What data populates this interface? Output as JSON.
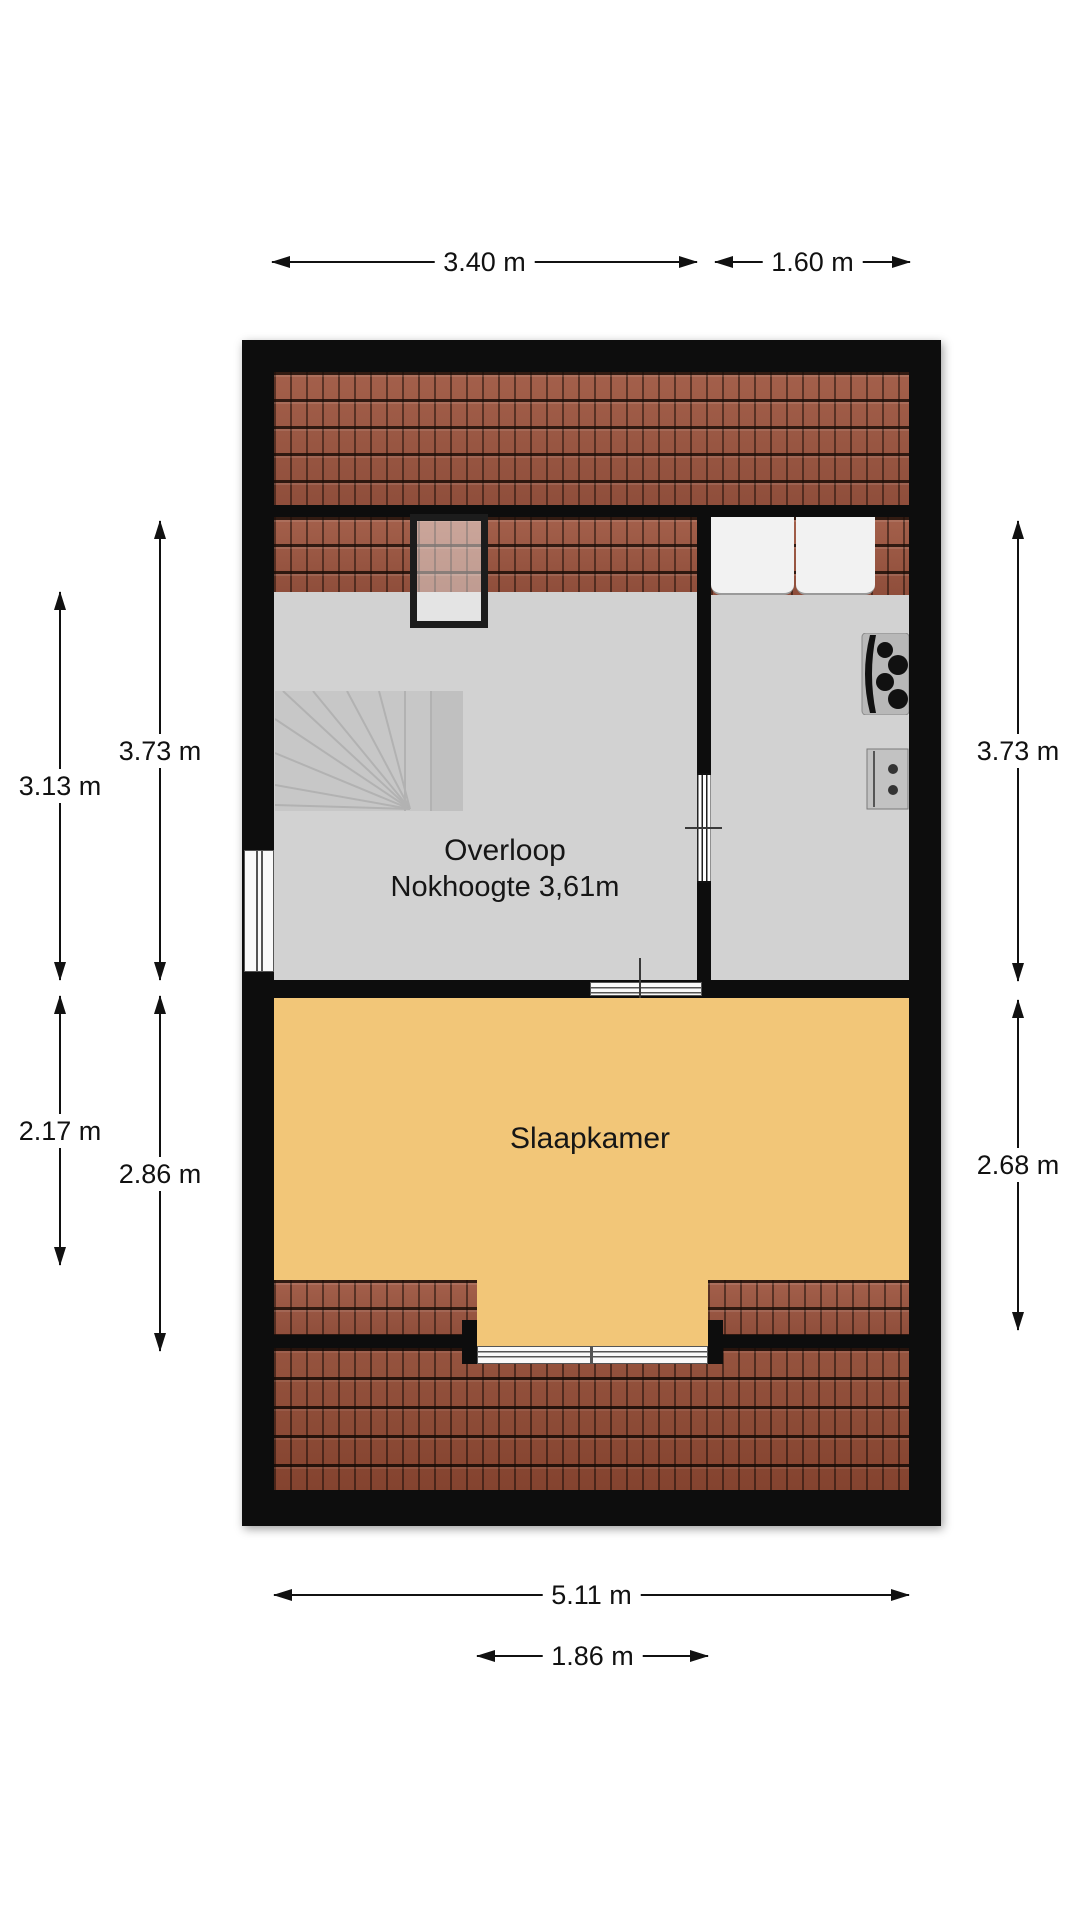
{
  "floorplan": {
    "rooms": {
      "overloop": {
        "label": "Overloop",
        "sub_label": "Nokhoogte 3,61m"
      },
      "slaapkamer": {
        "label": "Slaapkamer"
      }
    },
    "dimensions": {
      "top_left": "3.40 m",
      "top_right": "1.60 m",
      "left_outer_upper": "3.13 m",
      "left_inner_upper": "3.73 m",
      "left_outer_lower": "2.17 m",
      "left_inner_lower": "2.86 m",
      "right_upper": "3.73 m",
      "right_lower": "2.68 m",
      "bottom_total": "5.11 m",
      "bottom_dormer": "1.86 m"
    },
    "colors": {
      "wall": "#0d0d0d",
      "floor": "#d2d2d2",
      "bedroom_floor": "#f2c678",
      "roof_tile": "#9b5945",
      "roof_tile_dark": "#8c4a38"
    }
  }
}
